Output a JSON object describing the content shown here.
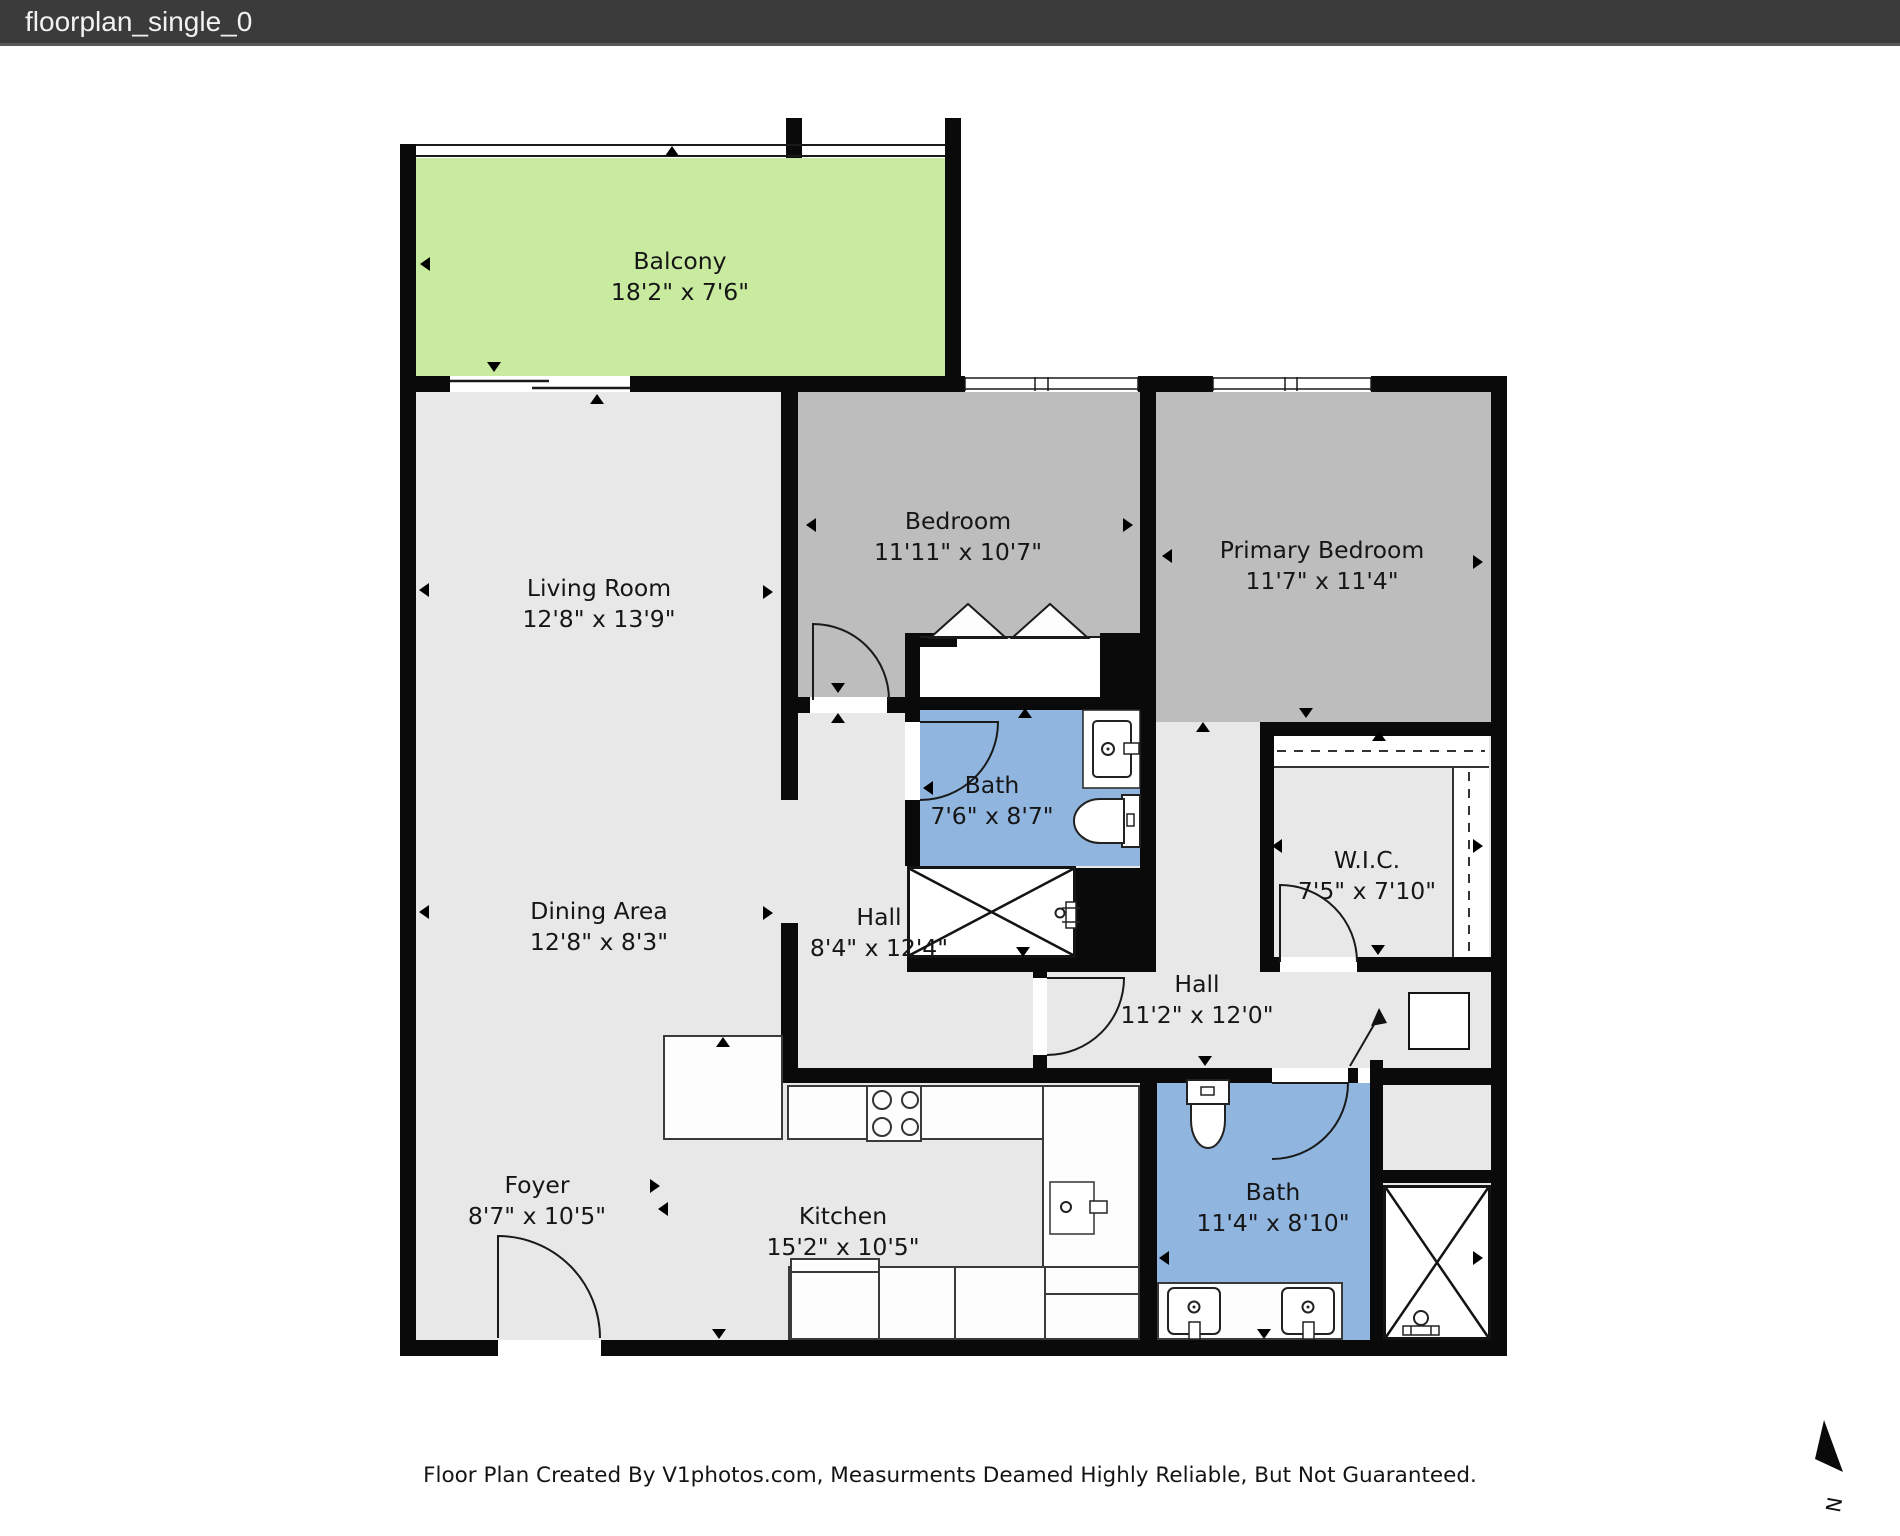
{
  "title_bar": {
    "title": "floorplan_single_0"
  },
  "floorplan": {
    "rooms": [
      {
        "id": "balcony",
        "name": "Balcony",
        "dims": "18'2\" x 7'6\""
      },
      {
        "id": "living-room",
        "name": "Living Room",
        "dims": "12'8\" x 13'9\""
      },
      {
        "id": "dining-area",
        "name": "Dining Area",
        "dims": "12'8\" x 8'3\""
      },
      {
        "id": "foyer",
        "name": "Foyer",
        "dims": "8'7\" x 10'5\""
      },
      {
        "id": "kitchen",
        "name": "Kitchen",
        "dims": "15'2\" x 10'5\""
      },
      {
        "id": "bedroom",
        "name": "Bedroom",
        "dims": "11'11\" x 10'7\""
      },
      {
        "id": "primary-bedroom",
        "name": "Primary Bedroom",
        "dims": "11'7\" x 11'4\""
      },
      {
        "id": "bath-upper",
        "name": "Bath",
        "dims": "7'6\" x 8'7\""
      },
      {
        "id": "wic",
        "name": "W.I.C.",
        "dims": "7'5\" x 7'10\""
      },
      {
        "id": "hall-upper",
        "name": "Hall",
        "dims": "8'4\" x 12'4\""
      },
      {
        "id": "hall-lower",
        "name": "Hall",
        "dims": "11'2\" x 12'0\""
      },
      {
        "id": "bath-lower",
        "name": "Bath",
        "dims": "11'4\" x 8'10\""
      }
    ],
    "colors": {
      "wall": "#0a0a0a",
      "floor": "#e8e8e8",
      "bedroom_floor": "#bdbdbd",
      "bath_floor": "#90b6e0",
      "balcony_floor": "#c8eb9f",
      "fixture": "#ffffff"
    },
    "compass": {
      "label": "N"
    }
  },
  "footer": {
    "disclaimer": "Floor Plan Created By V1photos.com, Measurments Deamed Highly Reliable, But Not Guaranteed."
  }
}
